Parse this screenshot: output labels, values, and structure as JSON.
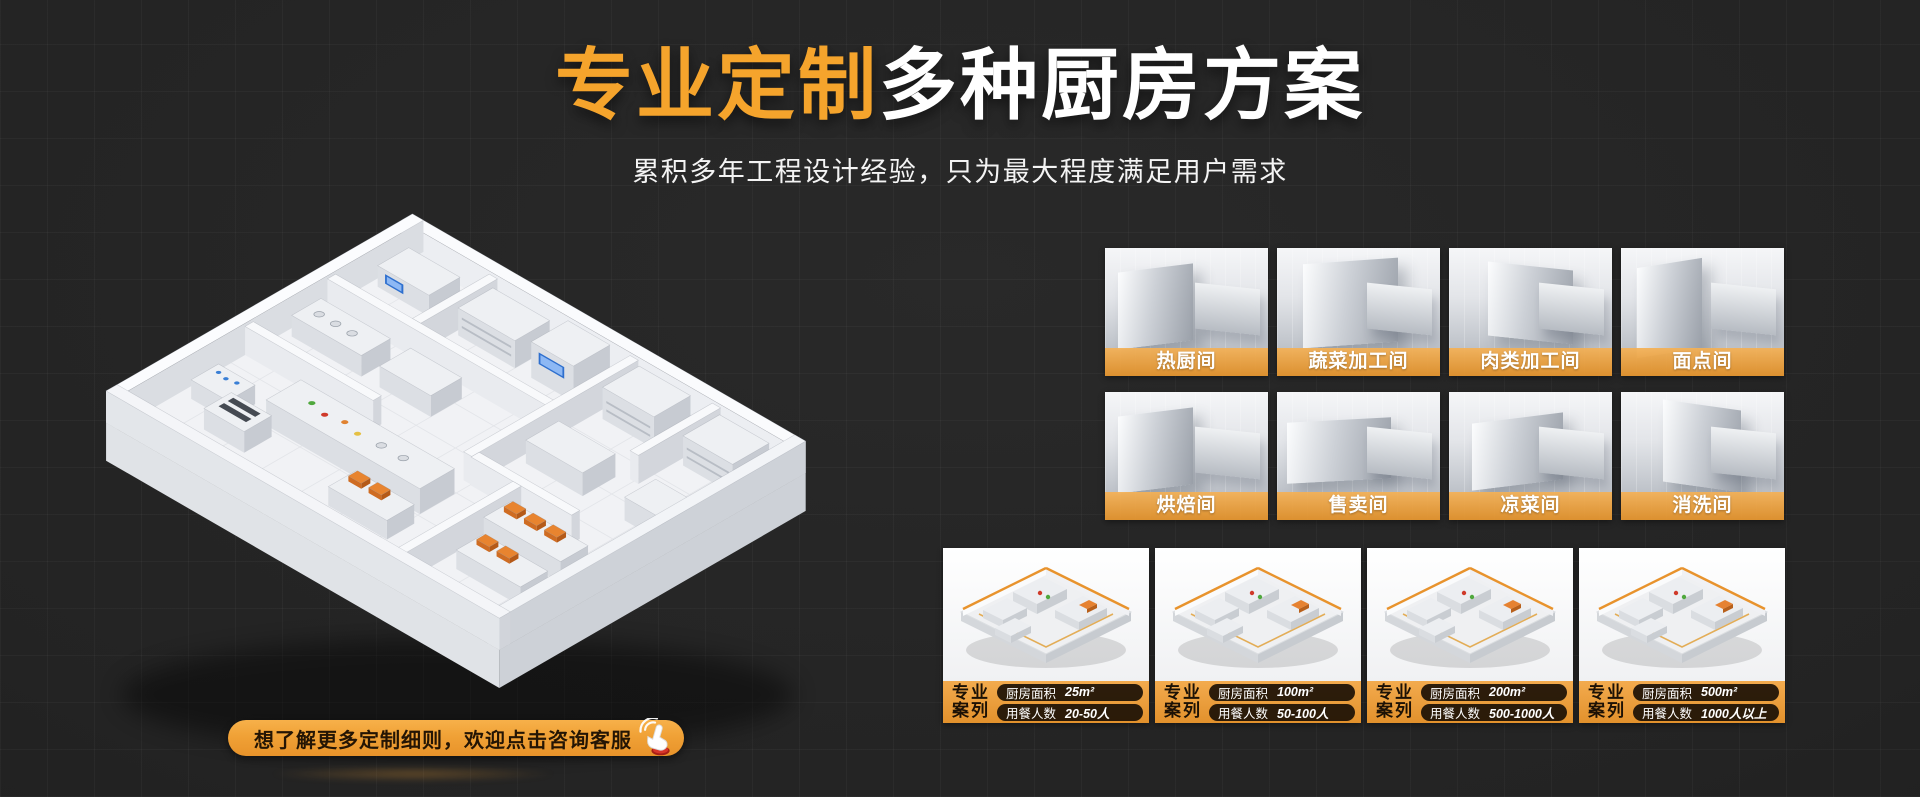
{
  "hero": {
    "title_highlight": "专业定制",
    "title_rest": "多种厨房方案",
    "subtitle": "累积多年工程设计经验，只为最大程度满足用户需求"
  },
  "cta": {
    "label": "想了解更多定制细则，欢迎点击咨询客服",
    "icon": "hand-click-icon"
  },
  "rooms": [
    {
      "label": "热厨间"
    },
    {
      "label": "蔬菜加工间"
    },
    {
      "label": "肉类加工间"
    },
    {
      "label": "面点间"
    },
    {
      "label": "烘焙间"
    },
    {
      "label": "售卖间"
    },
    {
      "label": "凉菜间"
    },
    {
      "label": "消洗间"
    }
  ],
  "case_tag": {
    "line1": "专业",
    "line2": "案列"
  },
  "case_labels": {
    "area": "厨房面积",
    "diners": "用餐人数"
  },
  "cases": [
    {
      "area": "25m²",
      "diners": "20-50人"
    },
    {
      "area": "100m²",
      "diners": "50-100人"
    },
    {
      "area": "200m²",
      "diners": "500-1000人"
    },
    {
      "area": "500m²",
      "diners": "1000人以上"
    }
  ],
  "colors": {
    "accent_orange": "#F5A42C",
    "label_bar_orange": "#E79A36",
    "background": "#232323",
    "pill_dark": "#160D04"
  }
}
